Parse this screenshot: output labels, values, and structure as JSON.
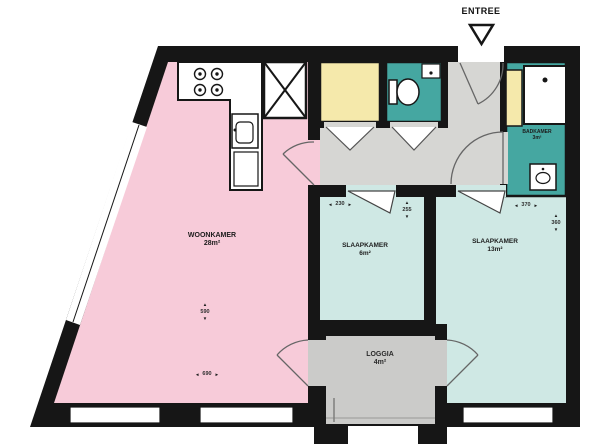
{
  "plan": {
    "entree_label": "ENTREE",
    "rooms": {
      "woonkamer": {
        "name": "WOONKAMER",
        "area": "28m²"
      },
      "slaapkamer_small": {
        "name": "SLAAPKAMER",
        "area": "6m²"
      },
      "slaapkamer_large": {
        "name": "SLAAPKAMER",
        "area": "13m²"
      },
      "loggia": {
        "name": "LOGGIA",
        "area": "4m²"
      },
      "badkamer": {
        "name": "BADKAMER",
        "area": "3m²"
      }
    },
    "dimensions": {
      "woonkamer_width": "690",
      "woonkamer_depth": "590",
      "slaapkamer_small_width": "230",
      "slaapkamer_small_depth": "255",
      "slaapkamer_large_width": "370",
      "slaapkamer_large_depth": "360"
    },
    "icons": {
      "up": "▲",
      "down": "▼",
      "left": "◄",
      "right": "►"
    },
    "colors": {
      "living": "#f7cbd9",
      "bedroom": "#cfe8e4",
      "sanitary": "#45a7a1",
      "closet": "#f5e9ab",
      "hall": "#d6d6d3",
      "loggia": "#cbcbc9",
      "wall": "#161616"
    }
  }
}
